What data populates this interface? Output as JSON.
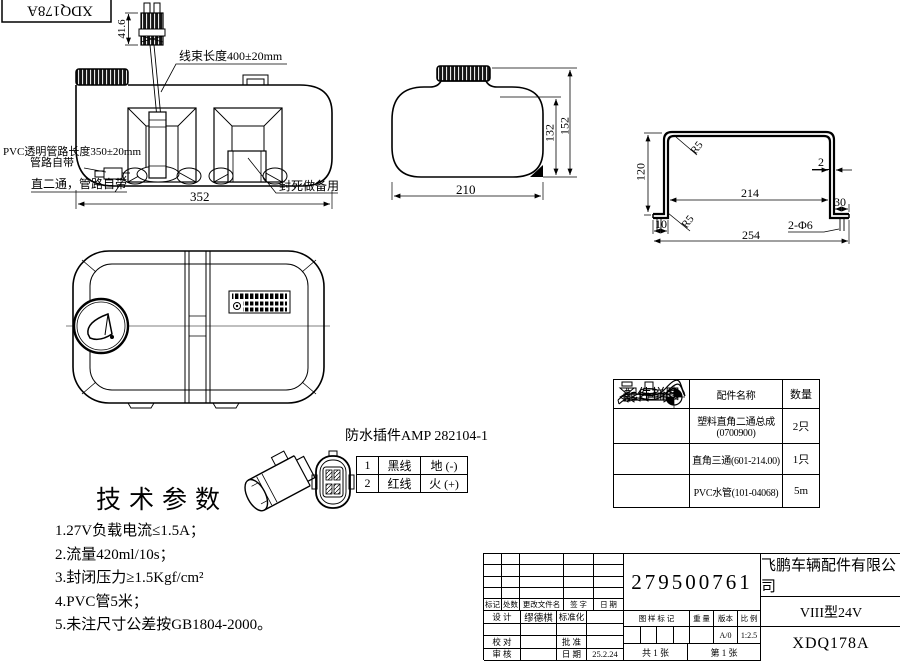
{
  "page": {
    "background": "#ffffff",
    "ink": "#000000"
  },
  "doc_code_box": {
    "text": "XDQ178A"
  },
  "front_view": {
    "dim_height_41_6": "41.6",
    "harness_label": "线束长度400±20mm",
    "pvc_label_line1": "PVC透明管路长度350±20mm",
    "pvc_label_line2": "管路自带",
    "straight_fitting_label": "直二通，管路自带",
    "sealed_spare_label": "封死做备用",
    "dim_width_352": "352"
  },
  "side_view": {
    "dim_width_210": "210",
    "dim_height_132": "132",
    "dim_height_152": "152"
  },
  "bracket_view": {
    "dim_height_120": "120",
    "radius_top": "R5",
    "radius_bottom": "R5",
    "dim_thickness_2": "2",
    "dim_inner_214": "214",
    "dim_flange_30": "30",
    "dim_flange_10": "10",
    "dim_overall_254": "254",
    "holes_label": "2-Φ6"
  },
  "connector": {
    "title": "防水插件AMP 282104-1",
    "pins": [
      {
        "no": "1",
        "wire": "黑线",
        "signal": "地 (-)"
      },
      {
        "no": "2",
        "wire": "红线",
        "signal": "火 (+)"
      }
    ]
  },
  "tech_params": {
    "title": "技术参数",
    "items": [
      "1.27V负载电流≤1.5A；",
      "2.流量420ml/10s；",
      "3.封闭压力≥1.5Kgf/cm²",
      "4.PVC管5米；",
      "5.未注尺寸公差按GB1804-2000。"
    ]
  },
  "parts_table": {
    "headers": [
      "配件样图",
      "配件名称",
      "数量"
    ],
    "rows": [
      {
        "icon": "elbow-two-way-fitting",
        "name_line1": "塑料直角二通总成",
        "name_line2": "(0700900)",
        "qty": "2只"
      },
      {
        "icon": "tee-three-way-fitting",
        "name_line1": "直角三通(601-214.00)",
        "name_line2": "",
        "qty": "1只"
      },
      {
        "icon": "pvc-water-tube",
        "name_line1": "PVC水管(101-04068)",
        "name_line2": "",
        "qty": "5m"
      }
    ]
  },
  "title_block": {
    "part_number": "279500761",
    "company": "飞鹏车辆配件有限公司",
    "model": "VIII型24V",
    "drawing_no": "XDQ178A",
    "revision_headers": [
      "标记",
      "处数",
      "更改文件名",
      "签 字",
      "日 期"
    ],
    "design_label": "设 计",
    "design_name": "缪德棋",
    "standardize_label": "标准化",
    "check_label": "校 对",
    "approve_label": "批 准",
    "review_label": "审 核",
    "date_label": "日 期",
    "date_value": "25.2.24",
    "stamp_headers": [
      "图 样 标 记",
      "重 量",
      "版本",
      "比 例"
    ],
    "version_value": "A/0",
    "scale_value": "1:2.5",
    "sheet_total": "共 1 张",
    "sheet_index": "第 1 张"
  }
}
